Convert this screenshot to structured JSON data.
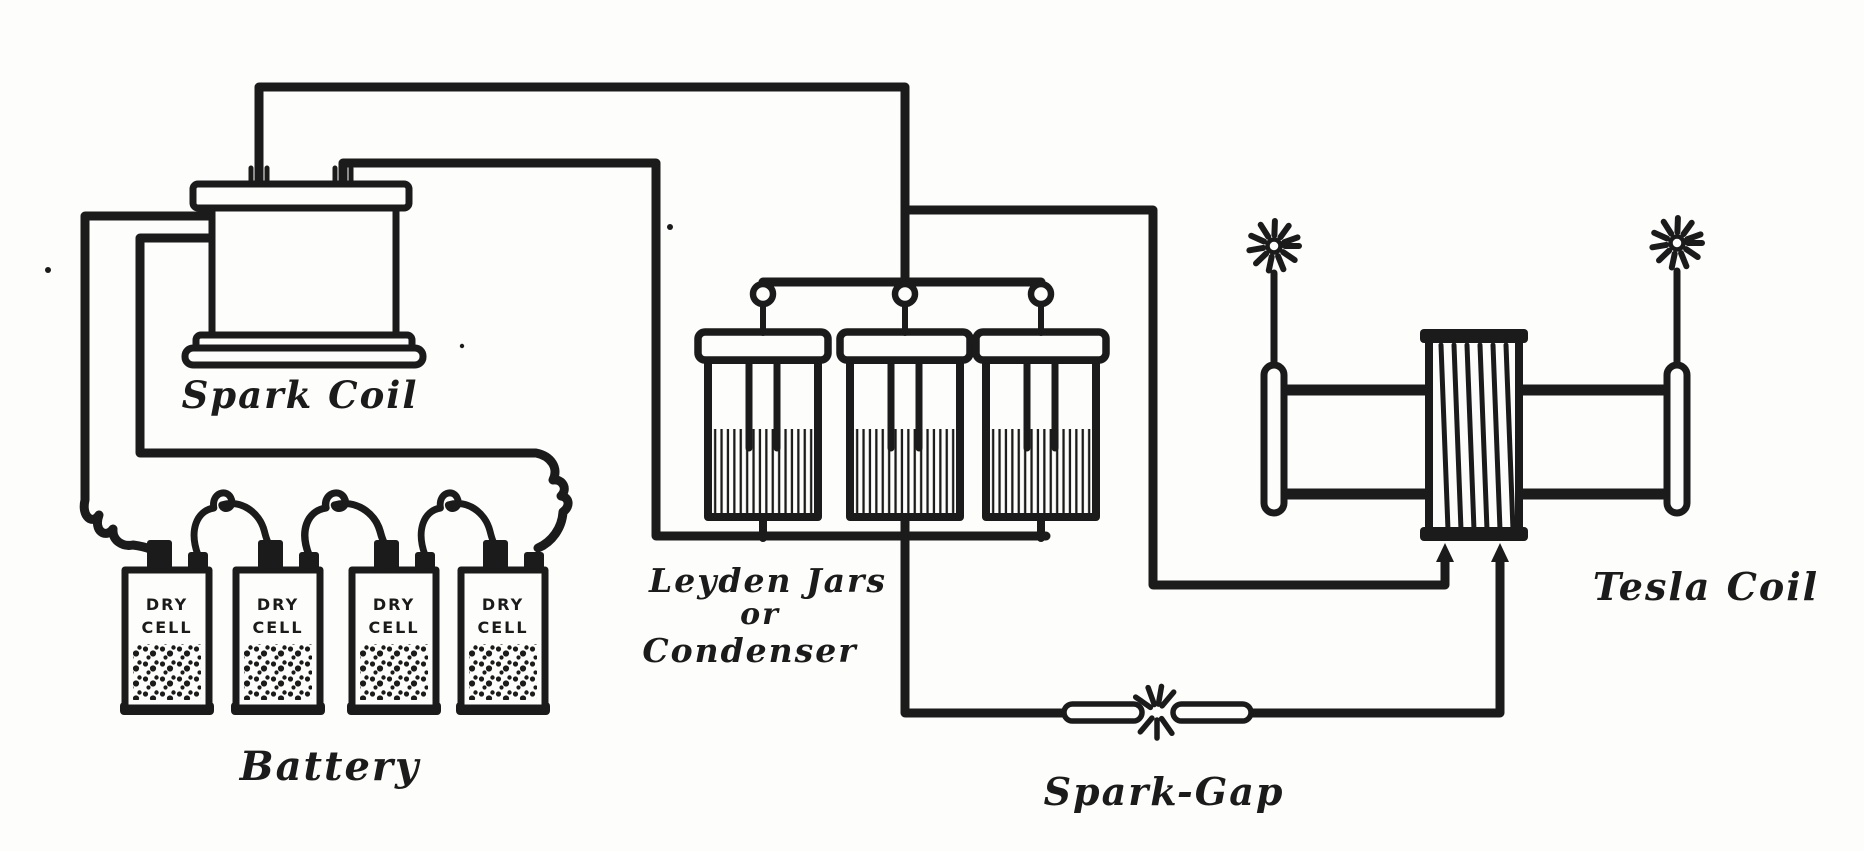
{
  "colors": {
    "ink": "#1b1b1b",
    "paper": "#fdfdfb"
  },
  "diagram": {
    "spark_coil": {
      "label": "Spark Coil"
    },
    "battery": {
      "label": "Battery",
      "cells": [
        {
          "label_line1": "DRY",
          "label_line2": "CELL"
        },
        {
          "label_line1": "DRY",
          "label_line2": "CELL"
        },
        {
          "label_line1": "DRY",
          "label_line2": "CELL"
        },
        {
          "label_line1": "DRY",
          "label_line2": "CELL"
        }
      ]
    },
    "condenser": {
      "label_line1": "Leyden Jars",
      "label_line2": "or",
      "label_line3": "Condenser",
      "jar_count": 3
    },
    "spark_gap": {
      "label": "Spark-Gap"
    },
    "tesla_coil": {
      "label": "Tesla Coil"
    }
  }
}
